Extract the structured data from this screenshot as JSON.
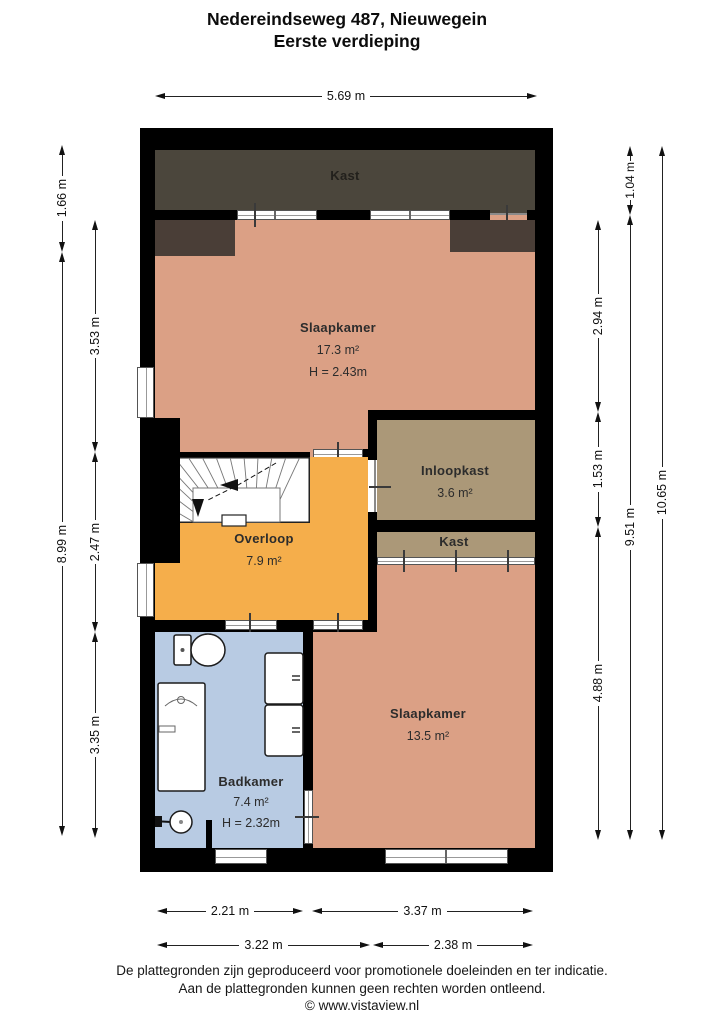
{
  "header": {
    "title": "Nedereindseweg 487, Nieuwegein",
    "subtitle": "Eerste verdieping"
  },
  "rooms": {
    "kast_top": {
      "label": "Kast"
    },
    "slaapkamer_1": {
      "label": "Slaapkamer",
      "area": "17.3 m²",
      "ceiling": "H = 2.43m"
    },
    "inloopkast": {
      "label": "Inloopkast",
      "area": "3.6 m²"
    },
    "overloop": {
      "label": "Overloop",
      "area": "7.9 m²"
    },
    "kast_2": {
      "label": "Kast"
    },
    "slaapkamer_2": {
      "label": "Slaapkamer",
      "area": "13.5 m²"
    },
    "badkamer": {
      "label": "Badkamer",
      "area": "7.4 m²",
      "ceiling": "H = 2.32m"
    }
  },
  "dimensions": {
    "top": "5.69 m",
    "left_outer": [
      "1.66 m",
      "8.99 m"
    ],
    "left_inner": [
      "3.53 m",
      "2.47 m",
      "3.35 m"
    ],
    "right_inner": [
      "2.94 m",
      "1.53 m",
      "4.88 m"
    ],
    "right_middle": [
      "1.04 m",
      "9.51 m"
    ],
    "right_outer": [
      "10.65 m"
    ],
    "bottom_row1": [
      "2.21 m",
      "3.37 m"
    ],
    "bottom_row2": [
      "3.22 m",
      "2.38 m"
    ]
  },
  "footer": {
    "line1": "De plattegronden zijn geproduceerd voor promotionele doeleinden en ter indicatie.",
    "line2": "Aan de plattegronden kunnen geen rechten worden ontleend.",
    "line3": "© www.vistaview.nl"
  },
  "colors": {
    "wall": "#000000",
    "bedroom": "#dba085",
    "landing": "#f5ae4b",
    "closet": "#ab9878",
    "bathroom": "#b8cbe3",
    "attic-closet": "#4b463c",
    "knee-wall": "#4a3e37"
  }
}
